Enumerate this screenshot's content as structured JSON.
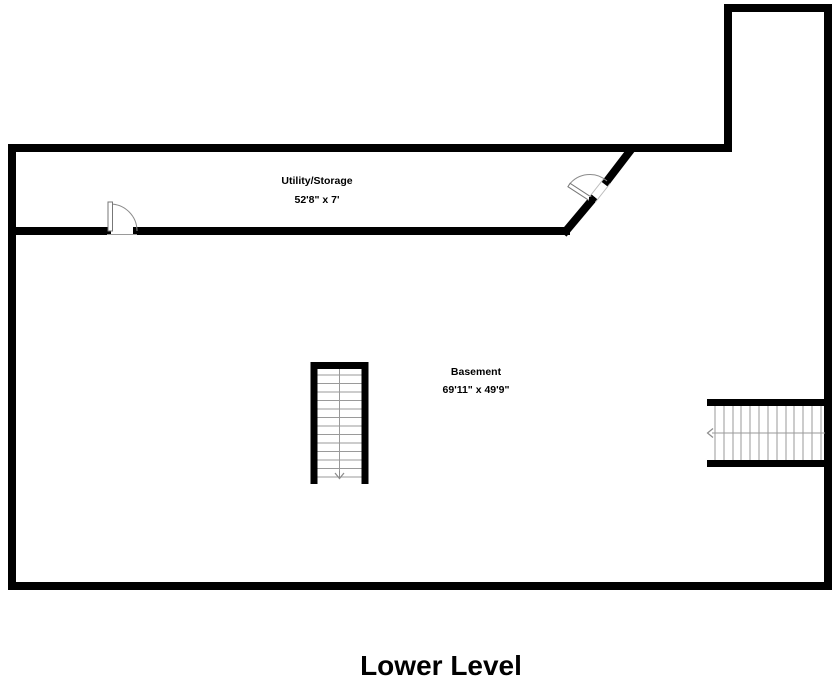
{
  "title": "Lower Level",
  "colors": {
    "wall": "#000000",
    "tread": "#9a9a9a",
    "door": "#8c8c8c",
    "door_leaf_outline": "#777777"
  },
  "rooms": [
    {
      "name": "Utility/Storage",
      "dimensions": "52'8\" x 7'"
    },
    {
      "name": "Basement",
      "dimensions": "69'11\" x 49'9\""
    }
  ],
  "stairs": [
    {
      "name": "center-staircase",
      "arrow": "down"
    },
    {
      "name": "right-staircase",
      "arrow": "left"
    }
  ],
  "doors": [
    {
      "name": "utility-room-door",
      "location": "utility-room-bottom-wall"
    },
    {
      "name": "diagonal-wall-door",
      "location": "utility-room-diagonal-wall"
    }
  ]
}
